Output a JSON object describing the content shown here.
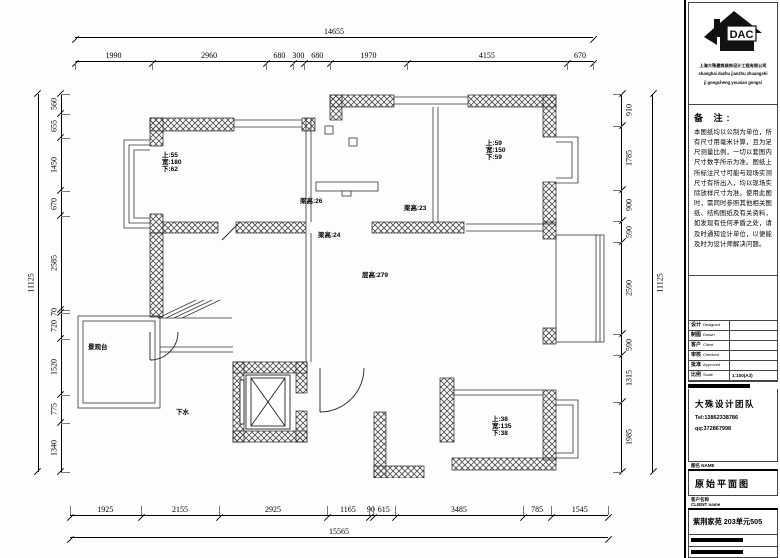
{
  "dimensions": {
    "top_total": "14655",
    "top": [
      1990,
      2960,
      680,
      300,
      680,
      1970,
      4155,
      670
    ],
    "bottom": [
      1925,
      2155,
      2925,
      1165,
      90,
      615,
      3485,
      785,
      1545
    ],
    "bottom_total": "15565",
    "left_total": "11125",
    "left": [
      560,
      655,
      1450,
      670,
      2585,
      70,
      720,
      1520,
      775,
      1340
    ],
    "right": [
      910,
      1785,
      900,
      590,
      2590,
      590,
      1315,
      1985
    ],
    "right_total": "11125"
  },
  "plan": {
    "labels": [
      {
        "name": "window-spec-label",
        "x": 162,
        "y": 152,
        "lines": [
          "上:55",
          "宽:180",
          "下:62"
        ]
      },
      {
        "name": "window-spec-label",
        "x": 486,
        "y": 140,
        "lines": [
          "上:59",
          "宽:150",
          "下:59"
        ]
      },
      {
        "name": "window-spec-label",
        "x": 492,
        "y": 416,
        "lines": [
          "上:38",
          "宽:135",
          "下:38"
        ]
      },
      {
        "name": "beam-height-label",
        "x": 300,
        "y": 198,
        "lines": [
          "梁高:26"
        ]
      },
      {
        "name": "beam-height-label",
        "x": 404,
        "y": 205,
        "lines": [
          "梁高:23"
        ]
      },
      {
        "name": "beam-height-label",
        "x": 318,
        "y": 232,
        "lines": [
          "梁高:24"
        ]
      },
      {
        "name": "ceiling-height-label",
        "x": 362,
        "y": 272,
        "lines": [
          "层高:279"
        ]
      },
      {
        "name": "balcony-label",
        "x": 88,
        "y": 344,
        "lines": [
          "景观台"
        ]
      },
      {
        "name": "drain-label",
        "x": 176,
        "y": 409,
        "lines": [
          "下水"
        ]
      }
    ]
  },
  "panel": {
    "logo": {
      "text": "DAC",
      "company_cn": "上海大殊建筑装饰设计工程有限公司",
      "company_en1": "shanghai dazhu jianzhu zhuangshi",
      "company_en2": "ji gongcheng youxian gongsi"
    },
    "notes": {
      "title": "备  注:",
      "body": "本图纸均以公制为单位，所有尺寸用毫米计算，且为足尺测量比例，一切以套图内尺寸数字所示为准。图纸上所标注尺寸可能与现场实测尺寸有所出入，均以现场实际放样尺寸为准。使用此图时，需同时参照其他相关图纸、结构图纸及有关资料，如发现有任何矛盾之处，请及时通知设计单位，以便能及时为设计师解决问题。"
    },
    "table": {
      "rows": [
        {
          "cn": "设计",
          "en": "Designed",
          "value": ""
        },
        {
          "cn": "制图",
          "en": "Drawn",
          "value": ""
        },
        {
          "cn": "客户",
          "en": "Client",
          "value": ""
        },
        {
          "cn": "审核",
          "en": "Checked",
          "value": ""
        },
        {
          "cn": "批准",
          "en": "Approved",
          "value": ""
        },
        {
          "cn": "比例",
          "en": "Scale",
          "value": "1:100(A3)"
        }
      ]
    },
    "team": {
      "name": "大殊设计团队",
      "tel": "Tel:13862338786",
      "qq": "qq:372867998"
    },
    "drawing": {
      "label": "图名 NAME",
      "title": "原始平面图",
      "client_label_1": "客户名称",
      "client_label_2": "CLIENT  name",
      "project": "紫荆家苑  203单元505"
    }
  }
}
